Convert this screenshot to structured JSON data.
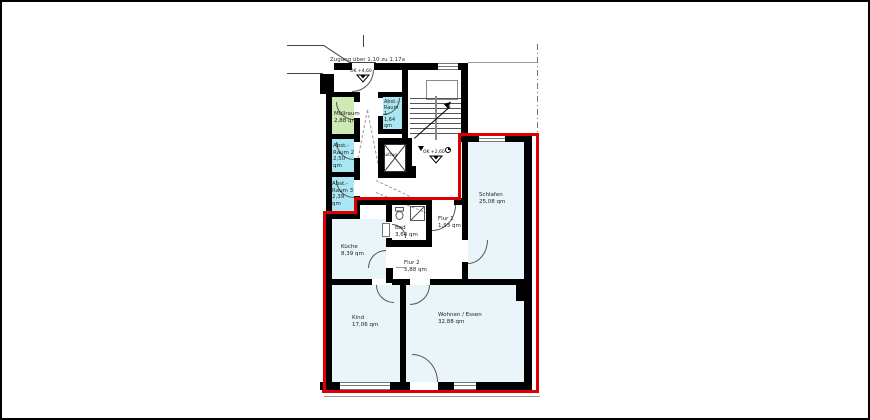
{
  "drawing": {
    "type": "apartment floor plan",
    "access_note": "Zugang über 1.10 zu 1.17a",
    "entry_level_marker": "OK +4,60",
    "stair_level_marker": "OK +2,60",
    "elevator_label": "Aufzug"
  },
  "colors": {
    "apartment_boundary": "#dd0000",
    "wall": "#000000",
    "storage_room_fill": "#a9e7f5",
    "waste_room_fill": "#cfe9b5",
    "apartment_room_fill": "#e9f5f8"
  },
  "rooms": [
    {
      "name": "Müllraum",
      "area": "2,88 qm"
    },
    {
      "name": "Abst.- Raum 1",
      "area": "1,64 qm"
    },
    {
      "name": "Abst.- Raum 2",
      "area": "2,50 qm"
    },
    {
      "name": "Abst.- Raum 3",
      "area": "2,39 qm"
    },
    {
      "name": "Bad",
      "area": "3,64 qm"
    },
    {
      "name": "Flur 1",
      "area": "1,93 qm"
    },
    {
      "name": "Flur 2",
      "area": "5,88 qm"
    },
    {
      "name": "Küche",
      "area": "8,39 qm"
    },
    {
      "name": "Schlafen",
      "area": "25,08 qm"
    },
    {
      "name": "Kind",
      "area": "17,06 qm"
    },
    {
      "name": "Wohnen / Essen",
      "area": "32,88 qm"
    }
  ]
}
